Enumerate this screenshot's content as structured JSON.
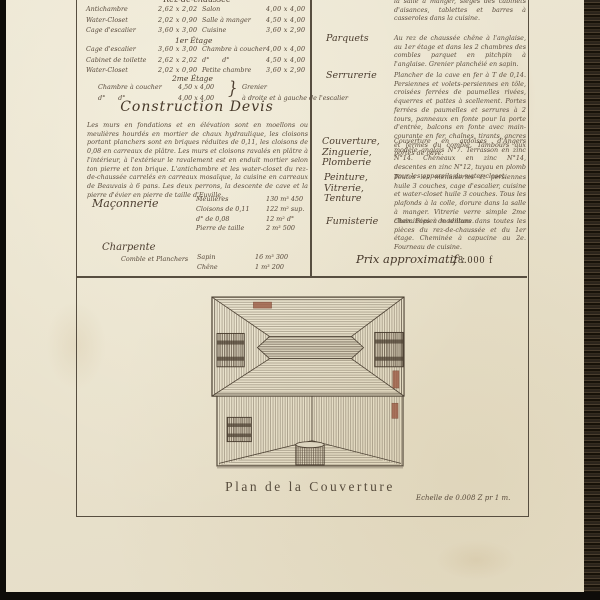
{
  "document": {
    "floor_table": {
      "header_rdc": "Rez-de-chaussée",
      "header_1er": "1er Étage",
      "header_2me": "2me Étage",
      "brace": "}",
      "rows_rdc": [
        {
          "room_l": "Antichambre",
          "dim_l": "2,62 x 2,02",
          "room_r": "Salon",
          "dim_r": "4,00 x 4,00"
        },
        {
          "room_l": "Water-Closet",
          "dim_l": "2,02 x 0,90",
          "room_r": "Salle à manger",
          "dim_r": "4,50 x 4,00"
        },
        {
          "room_l": "Cage d'escalier",
          "dim_l": "3,60 x 3,00",
          "room_r": "Cuisine",
          "dim_r": "3,60 x 2,90"
        }
      ],
      "rows_1er": [
        {
          "room_l": "Cage d'escalier",
          "dim_l": "3,60 x 3,00",
          "room_r": "Chambre à coucher",
          "dim_r": "4,00 x 4,00"
        },
        {
          "room_l": "Cabinet de toilette",
          "dim_l": "2,62 x 2,02",
          "room_r": "d°　　d°",
          "dim_r": "4,50 x 4,00"
        },
        {
          "room_l": "Water-Closet",
          "dim_l": "2,02 x 0,90",
          "room_r": "Petite chambre",
          "dim_r": "3,60 x 2,90"
        }
      ],
      "rows_2me": [
        {
          "room_l": "Chambre à coucher",
          "dim_l": "4,50 x 4,00",
          "note": "Grenier"
        },
        {
          "room_l": "d°　　d°",
          "dim_l": "4,00 x 4,00",
          "note": "à droite et à gauche de l'escalier"
        }
      ]
    },
    "devis": {
      "title": "Construction  Devis",
      "paragraph": "Les murs en fondations et en élévation sont en moellons ou meulières hourdés en mortier de chaux hydraulique, les cloisons portant planchers sont en briques réduites de 0,11, les cloisons de 0,08 en carreaux de plâtre. Les murs et cloisons ravalés en plâtre à l'intérieur, à l'extérieur le ravalement est en enduit mortier selon ton pierre et ton brique. L'antichambre et les water-closet du rez-de-chaussée carrelés en carreaux mosaïque, la cuisine en carreaux de Beauvais à 6 pans. Les deux perrons, la descente de cave et la pierre d'évier en pierre de taille d'Euville.",
      "maconnerie": {
        "label": "Maçonnerie",
        "items": [
          {
            "name": "Meulières",
            "value": "130 m³ 450"
          },
          {
            "name": "Cloisons de 0,11",
            "value": "122 m² sup."
          },
          {
            "name": "d°  de 0,08",
            "value": "12 m² d°"
          },
          {
            "name": "Pierre de taille",
            "value": "2 m³ 500"
          }
        ]
      },
      "charpente": {
        "label": "Charpente",
        "sublabel": "Comble et Planchers",
        "items": [
          {
            "name": "Sapin",
            "value": "16 m³ 300"
          },
          {
            "name": "Chêne",
            "value": "1 m³ 200"
          }
        ]
      }
    },
    "right_column": {
      "intro_fragment": "la salle à manger, sièges des cabinets d'aisances, tablettes et barres à casseroles dans la cuisine.",
      "sections": [
        {
          "label": "Parquets",
          "text": "Au rez de chaussée chêne à l'anglaise, au 1er étage et dans les 2 chambres des combles parquet en pitchpin à l'anglaise. Grenier planchéié en sapin."
        },
        {
          "label": "Serrurerie",
          "text": "Plancher de la cave en fer à T de 0,14. Persiennes et volets-persiennes en tôle, croisées ferrées de paumelles rivées, équerres et pattes à scellement. Portes ferrées de paumelles et serrures à 2 tours, panneaux en fonte pour la porte d'entrée, balcons en fonte avec main-courante en fer, chaînes, tirants, ancres et fermes du comble. Tambours aux portes de cave."
        },
        {
          "label": "Couverture, Zinguerie, Plomberie",
          "text": "Couverture en ardoises d'Angers modèle anglais N°7. Terrasson en zinc N°14. Chéneaux en zinc N°14, descentes en zinc N°12, tuyau en plomb pour les appareils du water-closet."
        },
        {
          "label": "Peinture, Vitrerie, Tenture",
          "text": "Toutes les menuiseries et persiennes huile 3 couches, cage d'escalier, cuisine et water-closet huile 3 couches. Tous les plafonds à la colle, dorure dans la salle à manger. Vitrerie verre simple 2me choix. Papier de tenture."
        },
        {
          "label": "Fumisterie",
          "text": "Cheminées à modillons dans toutes les pièces du rez-de-chaussée et du 1er étage. Cheminée à capucine au 2e. Fourneau de cuisine."
        }
      ],
      "price_label": "Prix approximatif :",
      "price_value": "28.000 f"
    },
    "drawing": {
      "caption": "Plan de la Couverture",
      "scale_note": "Echelle de 0.008 Z pr 1 m."
    },
    "colors": {
      "paper": "#e9e2cd",
      "ink": "#56483a",
      "frame": "#574e40",
      "stamp_red": "#9b5a43"
    }
  }
}
